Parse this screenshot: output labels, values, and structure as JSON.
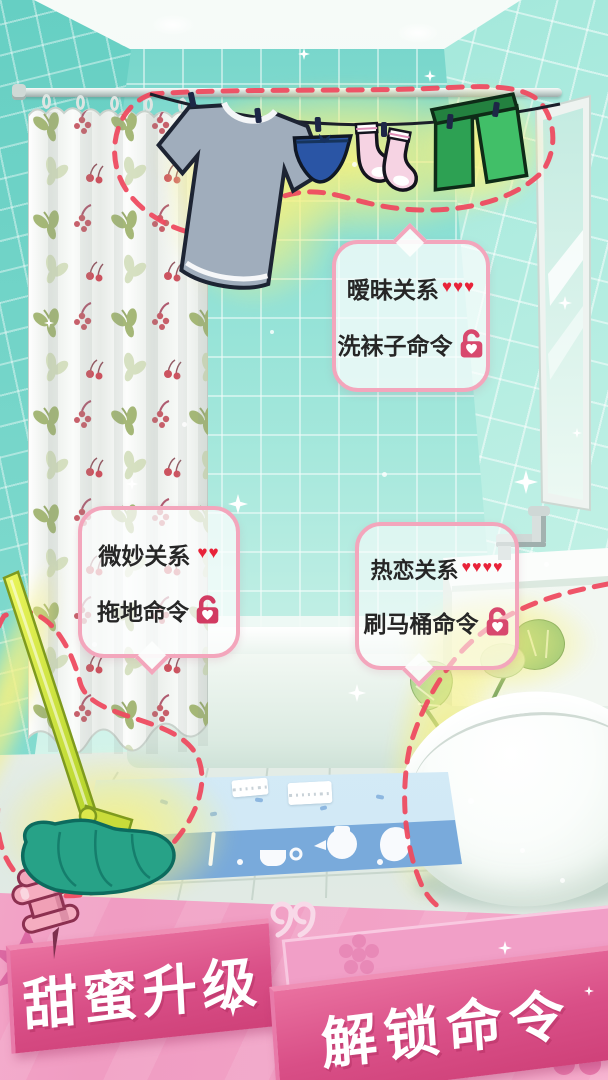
{
  "bubbles": [
    {
      "relationship": "暧昧关系",
      "hearts": "♥♥♥",
      "command": "洗袜子命令",
      "lock_state": "unlocked",
      "lock_icon": "unlock-heart-padlock-icon"
    },
    {
      "relationship": "微妙关系",
      "hearts": "♥♥",
      "command": "拖地命令",
      "lock_state": "unlocked",
      "lock_icon": "unlock-heart-padlock-icon"
    },
    {
      "relationship": "热恋关系",
      "hearts": "♥♥♥♥",
      "command": "刷马桶命令",
      "lock_state": "unlocked",
      "lock_icon": "unlock-heart-padlock-icon"
    }
  ],
  "banner": {
    "line1": "甜蜜升级",
    "line2": "解锁命令"
  },
  "icons": {
    "lock": "unlock-heart-padlock-icon",
    "pin": "push-pin-icon",
    "quote": "double-quote-icon",
    "sparkle": "sparkle-icon",
    "heart": "heart-icon"
  },
  "colors": {
    "wall": "#84dcd1",
    "panel_pink": "#f2a1c6",
    "ribbon_pink": "#d94f87",
    "dash_red": "#ee4b60",
    "glow_yellow": "#f4ee8a",
    "heart_red": "#e82339",
    "lock_pink": "#d8496e",
    "bubble_border": "#f3a6bc"
  }
}
